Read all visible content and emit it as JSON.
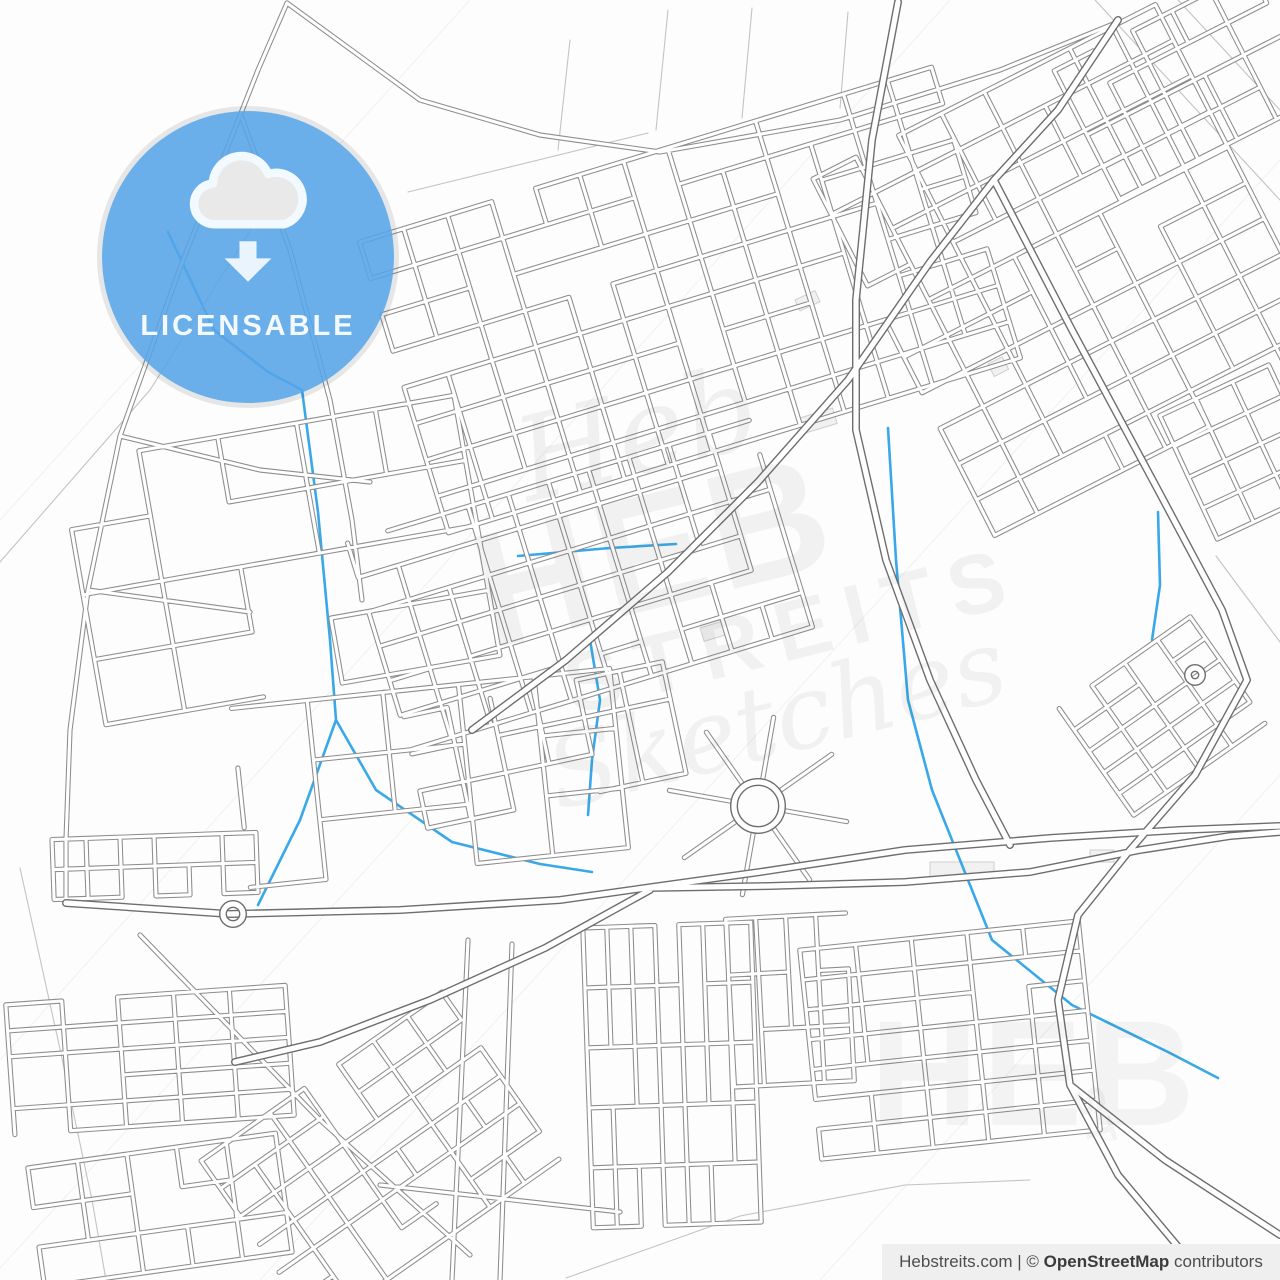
{
  "badge": {
    "label": "LICENSABLE",
    "icon": "cloud-download-icon",
    "color": "#55a4e7",
    "text_color": "#f3f9ff"
  },
  "attribution": {
    "prefix": "Hebstreits.com | © ",
    "bold": "OpenStreetMap",
    "suffix": " contributors"
  },
  "watermark": {
    "center": {
      "script_top": "Heb",
      "block_line1": "HEB",
      "block_line2": "STREITS",
      "script_bottom": "Sketches"
    },
    "corner": {
      "block": "HEB",
      "sub": "ST"
    }
  },
  "map": {
    "style": {
      "background": "#fdfdfd",
      "minor_casing": "#8d8d8d",
      "minor_casing_w": 5.2,
      "minor_fill": "#ffffff",
      "minor_fill_w": 3.1,
      "major_casing": "#6e6e6e",
      "major_casing_w": 8,
      "major_fill": "#ffffff",
      "major_fill_w": 5.2,
      "trail": "#c3c3c3",
      "trail_w": 1.1,
      "water": "#38a8e8",
      "water_w": 2.6,
      "wm_line": "rgba(0,0,0,0.045)",
      "wm_line_w": 1.2,
      "building_stroke": "#cfcfcf",
      "building_fill": "#f1f1f1"
    },
    "grids": [
      {
        "name": "top-main",
        "cx": 690,
        "cy": 300,
        "cols": 13,
        "rows": 8,
        "cw": 46,
        "ch": 38,
        "angle": -17,
        "drop": 0.1,
        "seed": 3
      },
      {
        "name": "top-right",
        "cx": 1075,
        "cy": 270,
        "cols": 8,
        "rows": 10,
        "cw": 48,
        "ch": 40,
        "angle": -27,
        "drop": 0.12,
        "seed": 4
      },
      {
        "name": "ne-corner",
        "cx": 1185,
        "cy": 85,
        "cols": 5,
        "rows": 4,
        "cw": 44,
        "ch": 36,
        "angle": -27,
        "drop": 0.15,
        "seed": 5
      },
      {
        "name": "center",
        "cx": 580,
        "cy": 585,
        "cols": 10,
        "rows": 6,
        "cw": 42,
        "ch": 36,
        "angle": -17,
        "drop": 0.1,
        "seed": 6
      },
      {
        "name": "center-south",
        "cx": 545,
        "cy": 745,
        "cols": 6,
        "rows": 3,
        "cw": 44,
        "ch": 38,
        "angle": -12,
        "drop": 0.2,
        "seed": 7
      },
      {
        "name": "left-blocks",
        "cx": 280,
        "cy": 560,
        "cols": 5,
        "rows": 4,
        "cw": 80,
        "ch": 66,
        "angle": -10,
        "drop": 0.18,
        "seed": 8
      },
      {
        "name": "campus",
        "cx": 430,
        "cy": 778,
        "cols": 5,
        "rows": 3,
        "cw": 76,
        "ch": 60,
        "angle": -6,
        "drop": 0.25,
        "seed": 9
      },
      {
        "name": "left-rowhouses",
        "cx": 155,
        "cy": 866,
        "cols": 6,
        "rows": 2,
        "cw": 34,
        "ch": 30,
        "angle": -2,
        "drop": 0.05,
        "seed": 10
      },
      {
        "name": "sw-rows",
        "cx": 150,
        "cy": 1060,
        "cols": 5,
        "rows": 5,
        "cw": 56,
        "ch": 26,
        "angle": -4,
        "drop": 0.08,
        "seed": 11
      },
      {
        "name": "sw-lower",
        "cx": 160,
        "cy": 1210,
        "cols": 5,
        "rows": 3,
        "cw": 50,
        "ch": 40,
        "angle": -8,
        "drop": 0.15,
        "seed": 12
      },
      {
        "name": "south-diagonal",
        "cx": 380,
        "cy": 1160,
        "cols": 7,
        "rows": 6,
        "cw": 42,
        "ch": 34,
        "angle": -35,
        "drop": 0.12,
        "seed": 13
      },
      {
        "name": "south-rowhouses",
        "cx": 672,
        "cy": 1075,
        "cols": 7,
        "rows": 5,
        "cw": 24,
        "ch": 60,
        "angle": -2,
        "drop": 0.06,
        "seed": 14
      },
      {
        "name": "south-rowhouses-b",
        "cx": 790,
        "cy": 1000,
        "cols": 4,
        "rows": 3,
        "cw": 30,
        "ch": 56,
        "angle": -3,
        "drop": 0.08,
        "seed": 15
      },
      {
        "name": "se-blocks",
        "cx": 950,
        "cy": 1040,
        "cols": 5,
        "rows": 7,
        "cw": 56,
        "ch": 30,
        "angle": -6,
        "drop": 0.08,
        "seed": 16
      },
      {
        "name": "mid-right-hatch",
        "cx": 1162,
        "cy": 716,
        "cols": 4,
        "rows": 5,
        "cw": 40,
        "ch": 26,
        "angle": -35,
        "drop": 0.08,
        "seed": 17
      },
      {
        "name": "right-edge",
        "cx": 1243,
        "cy": 452,
        "cols": 3,
        "rows": 4,
        "cw": 40,
        "ch": 34,
        "angle": -25,
        "drop": 0.1,
        "seed": 18
      }
    ],
    "arterials_major": [
      [
        [
          66,
          903
        ],
        [
          230,
          914
        ],
        [
          400,
          910
        ],
        [
          560,
          900
        ],
        [
          645,
          888
        ]
      ],
      [
        [
          645,
          888
        ],
        [
          760,
          872
        ],
        [
          905,
          850
        ],
        [
          1050,
          838
        ],
        [
          1180,
          830
        ],
        [
          1280,
          826
        ]
      ],
      [
        [
          645,
          888
        ],
        [
          770,
          886
        ],
        [
          905,
          882
        ],
        [
          1030,
          872
        ],
        [
          1140,
          850
        ],
        [
          1230,
          836
        ],
        [
          1280,
          832
        ]
      ],
      [
        [
          650,
          890
        ],
        [
          545,
          948
        ],
        [
          430,
          1000
        ],
        [
          320,
          1042
        ],
        [
          235,
          1062
        ]
      ],
      [
        [
          1118,
          20
        ],
        [
          1058,
          110
        ],
        [
          994,
          180
        ],
        [
          1072,
          330
        ],
        [
          1158,
          490
        ],
        [
          1222,
          610
        ],
        [
          1247,
          680
        ]
      ],
      [
        [
          1247,
          680
        ],
        [
          1195,
          775
        ],
        [
          1130,
          850
        ],
        [
          1078,
          915
        ],
        [
          1058,
          1000
        ],
        [
          1070,
          1085
        ],
        [
          1118,
          1175
        ],
        [
          1185,
          1255
        ],
        [
          1225,
          1280
        ]
      ],
      [
        [
          1070,
          1085
        ],
        [
          1165,
          1160
        ],
        [
          1280,
          1235
        ]
      ],
      [
        [
          898,
          2
        ],
        [
          872,
          140
        ],
        [
          856,
          300
        ],
        [
          856,
          430
        ],
        [
          886,
          560
        ],
        [
          930,
          680
        ],
        [
          976,
          780
        ],
        [
          1010,
          845
        ]
      ],
      [
        [
          994,
          180
        ],
        [
          930,
          262
        ],
        [
          848,
          380
        ],
        [
          758,
          482
        ],
        [
          668,
          572
        ],
        [
          566,
          660
        ],
        [
          472,
          730
        ]
      ]
    ],
    "arterials_minor": [
      [
        [
          287,
          3
        ],
        [
          258,
          70
        ],
        [
          180,
          268
        ],
        [
          120,
          436
        ],
        [
          88,
          590
        ],
        [
          70,
          730
        ],
        [
          66,
          840
        ],
        [
          66,
          903
        ]
      ],
      [
        [
          287,
          3
        ],
        [
          420,
          100
        ],
        [
          540,
          135
        ],
        [
          660,
          152
        ]
      ],
      [
        [
          660,
          152
        ],
        [
          840,
          120
        ],
        [
          1000,
          70
        ],
        [
          1118,
          22
        ]
      ],
      [
        [
          242,
          118
        ],
        [
          290,
          250
        ],
        [
          330,
          400
        ],
        [
          352,
          520
        ],
        [
          362,
          600
        ]
      ],
      [
        [
          120,
          436
        ],
        [
          260,
          470
        ],
        [
          370,
          482
        ]
      ],
      [
        [
          88,
          590
        ],
        [
          250,
          612
        ]
      ],
      [
        [
          468,
          940
        ],
        [
          452,
          1280
        ]
      ],
      [
        [
          512,
          944
        ],
        [
          500,
          1280
        ]
      ],
      [
        [
          380,
          1185
        ],
        [
          620,
          1212
        ]
      ],
      [
        [
          140,
          935
        ],
        [
          320,
          1120
        ],
        [
          470,
          1255
        ]
      ]
    ],
    "paths": [
      [
        [
          0,
          562
        ],
        [
          150,
          390
        ],
        [
          262,
          212
        ]
      ],
      [
        [
          408,
          192
        ],
        [
          648,
          133
        ]
      ],
      [
        [
          570,
          40
        ],
        [
          558,
          150
        ]
      ],
      [
        [
          668,
          10
        ],
        [
          656,
          130
        ]
      ],
      [
        [
          752,
          8
        ],
        [
          742,
          118
        ]
      ],
      [
        [
          848,
          12
        ],
        [
          840,
          108
        ]
      ],
      [
        [
          20,
          868
        ],
        [
          58,
          1040
        ],
        [
          92,
          1200
        ],
        [
          106,
          1280
        ]
      ],
      [
        [
          1095,
          0
        ],
        [
          1280,
          200
        ]
      ],
      [
        [
          1178,
          0
        ],
        [
          1280,
          110
        ]
      ],
      [
        [
          1216,
          556
        ],
        [
          1280,
          642
        ]
      ],
      [
        [
          566,
          1278
        ],
        [
          740,
          1216
        ],
        [
          905,
          1185
        ],
        [
          1030,
          1180
        ]
      ]
    ],
    "waterways": [
      [
        [
          168,
          232
        ],
        [
          214,
          330
        ],
        [
          268,
          372
        ],
        [
          302,
          390
        ],
        [
          318,
          512
        ],
        [
          330,
          640
        ],
        [
          336,
          720
        ],
        [
          300,
          820
        ],
        [
          258,
          905
        ]
      ],
      [
        [
          336,
          720
        ],
        [
          376,
          790
        ],
        [
          452,
          842
        ],
        [
          540,
          864
        ],
        [
          592,
          872
        ]
      ],
      [
        [
          888,
          428
        ],
        [
          896,
          560
        ],
        [
          908,
          700
        ],
        [
          932,
          790
        ],
        [
          992,
          940
        ],
        [
          1072,
          1005
        ],
        [
          1168,
          1052
        ],
        [
          1218,
          1078
        ]
      ],
      [
        [
          518,
          556
        ],
        [
          610,
          548
        ],
        [
          676,
          544
        ]
      ],
      [
        [
          590,
          640
        ],
        [
          600,
          700
        ],
        [
          592,
          760
        ],
        [
          588,
          815
        ]
      ],
      [
        [
          1158,
          512
        ],
        [
          1160,
          585
        ],
        [
          1152,
          640
        ]
      ]
    ],
    "watermark_lines": [
      [
        [
          0,
          520
        ],
        [
          470,
          0
        ]
      ],
      [
        [
          0,
          1060
        ],
        [
          950,
          0
        ]
      ],
      [
        [
          260,
          1280
        ],
        [
          1280,
          160
        ]
      ],
      [
        [
          820,
          1280
        ],
        [
          1280,
          775
        ]
      ],
      [
        [
          0,
          1268
        ],
        [
          430,
          800
        ]
      ]
    ],
    "buildings": [
      [
        800,
        418,
        34,
        16,
        -17
      ],
      [
        988,
        364,
        16,
        14,
        -27
      ],
      [
        930,
        862,
        64,
        16,
        0
      ],
      [
        1090,
        850,
        24,
        12,
        0
      ],
      [
        795,
        300,
        22,
        12,
        -25
      ],
      [
        700,
        628,
        26,
        14,
        -17
      ]
    ],
    "roundabouts": [
      {
        "cx": 233,
        "cy": 914,
        "r": 10,
        "spokes": 0,
        "spoke_len": 0,
        "spoke_start": 0
      },
      {
        "cx": 758,
        "cy": 806,
        "r": 24,
        "spokes": 8,
        "spoke_len": 66,
        "spoke_start": 10
      },
      {
        "cx": 1195,
        "cy": 675,
        "r": 7,
        "spokes": 0,
        "spoke_len": 0,
        "spoke_start": 0
      }
    ]
  }
}
